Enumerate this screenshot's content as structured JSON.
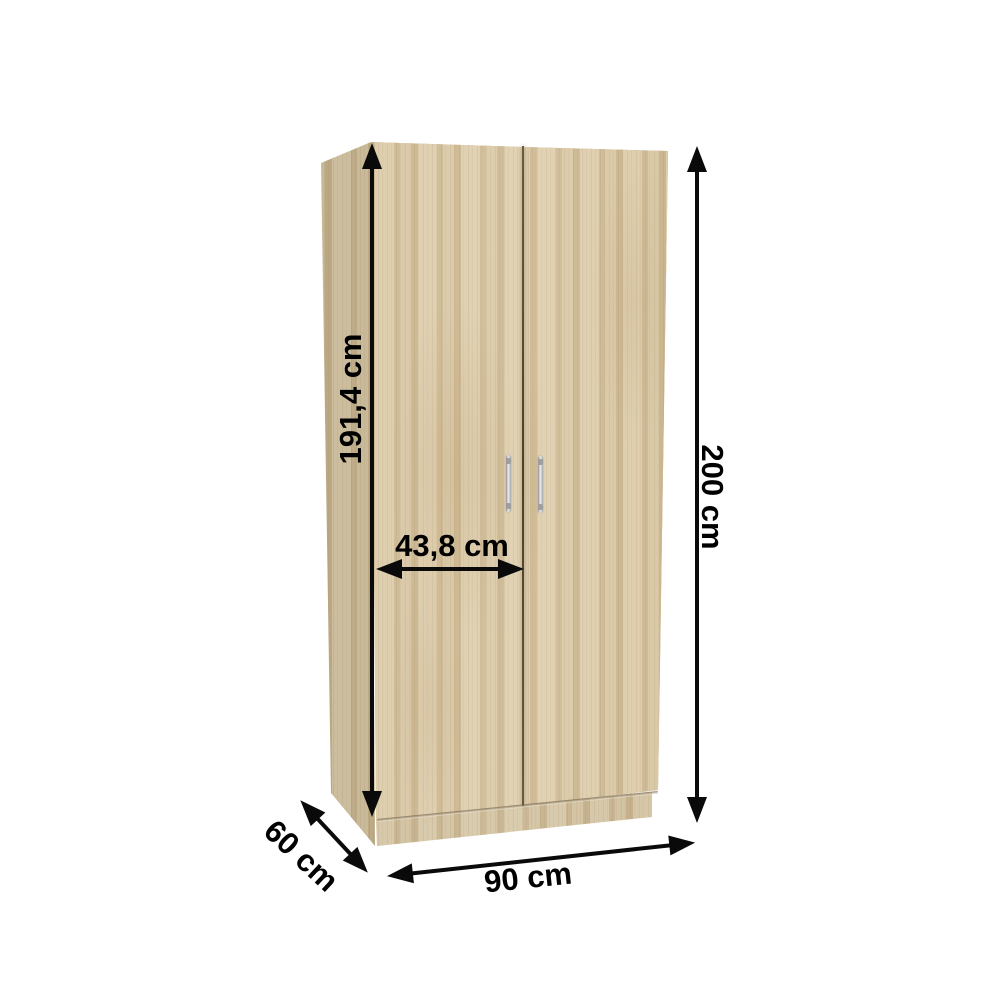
{
  "page": {
    "background": "#ffffff"
  },
  "wardrobe": {
    "colors": {
      "wood_base": "#d2c09c",
      "wood_light": "#e8dbbf",
      "wood_dark": "#c4ad85",
      "door_gap": "#5a4a33",
      "handle": "#c9c9c9",
      "arrow": "#000000"
    }
  },
  "dimensions": {
    "inner_height": {
      "label": "191,4 cm"
    },
    "door_width": {
      "label": "43,8 cm"
    },
    "total_height": {
      "label": "200 cm"
    },
    "depth": {
      "label": "60 cm"
    },
    "width": {
      "label": "90 cm"
    }
  }
}
